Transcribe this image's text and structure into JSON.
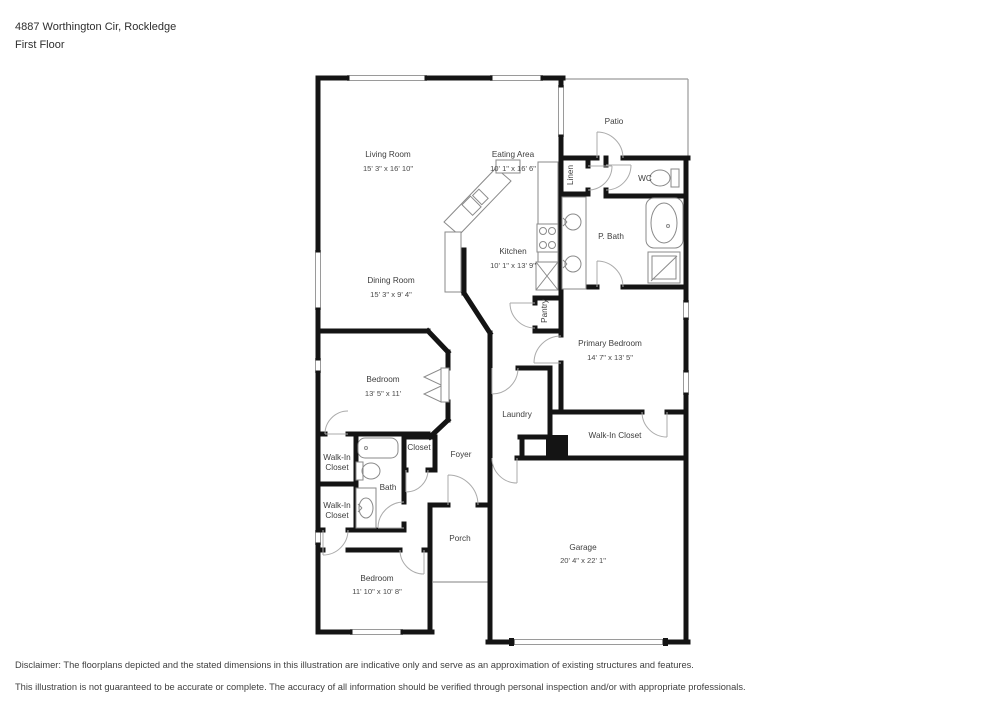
{
  "header": {
    "address": "4887 Worthington Cir, Rockledge",
    "floor": "First Floor"
  },
  "rooms": {
    "living_room": {
      "name": "Living Room",
      "dims": "15' 3\" x 16' 10\""
    },
    "eating_area": {
      "name": "Eating Area",
      "dims": "10' 1\" x 16' 6\""
    },
    "patio": {
      "name": "Patio"
    },
    "linen": {
      "name": "Linen"
    },
    "wc": {
      "name": "WC"
    },
    "p_bath": {
      "name": "P. Bath"
    },
    "kitchen": {
      "name": "Kitchen",
      "dims": "10' 1\" x 13' 9\""
    },
    "pantry": {
      "name": "Pantry"
    },
    "dining_room": {
      "name": "Dining Room",
      "dims": "15' 3\" x 9' 4\""
    },
    "primary_bedroom": {
      "name": "Primary Bedroom",
      "dims": "14' 7\" x 13' 5\""
    },
    "bedroom_mid": {
      "name": "Bedroom",
      "dims": "13' 5\" x 11'"
    },
    "laundry": {
      "name": "Laundry"
    },
    "walk_in_closet_primary": {
      "name": "Walk-In Closet"
    },
    "walk_in_closet_1": {
      "line1": "Walk-In",
      "line2": "Closet"
    },
    "walk_in_closet_2": {
      "line1": "Walk-In",
      "line2": "Closet"
    },
    "closet": {
      "name": "Closet"
    },
    "bath": {
      "name": "Bath"
    },
    "foyer": {
      "name": "Foyer"
    },
    "porch": {
      "name": "Porch"
    },
    "bedroom_bottom": {
      "name": "Bedroom",
      "dims": "11' 10\" x 10' 8\""
    },
    "garage": {
      "name": "Garage",
      "dims": "20' 4\" x 22' 1\""
    }
  },
  "disclaimer": {
    "line1": "Disclaimer: The floorplans depicted and the stated dimensions in this illustration are indicative only and serve as an approximation of existing structures and features.",
    "line2": "This illustration is not guaranteed to be accurate or complete. The accuracy of all information should be verified through personal inspection and/or with appropriate professionals."
  }
}
